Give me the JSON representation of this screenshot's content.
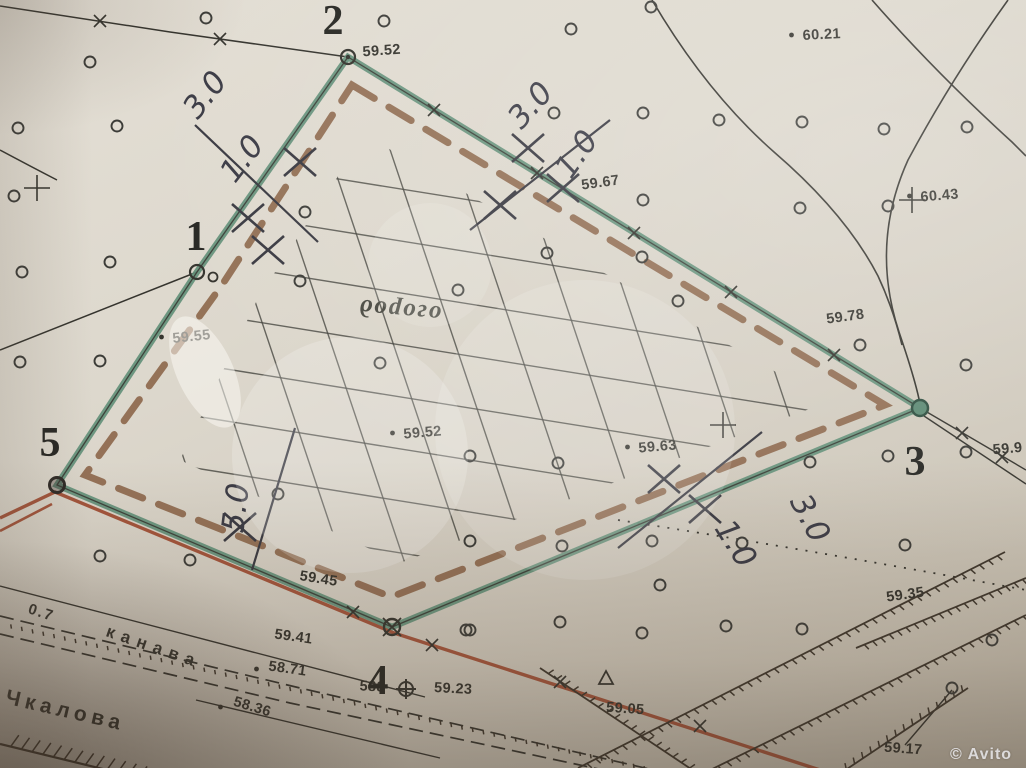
{
  "map": {
    "garden_label": {
      "text": "огород",
      "x": 400,
      "y": 303,
      "rot": 185
    },
    "corner_numbers": [
      {
        "text": "2",
        "x": 333,
        "y": 34
      },
      {
        "text": "1",
        "x": 196,
        "y": 250
      },
      {
        "text": "5",
        "x": 50,
        "y": 456
      },
      {
        "text": "4",
        "x": 378,
        "y": 694
      },
      {
        "text": "3",
        "x": 915,
        "y": 475
      }
    ],
    "elevation_points": [
      {
        "text": "59.52",
        "x": 382,
        "y": 55,
        "rot": -4,
        "dot": false
      },
      {
        "text": "60.21",
        "x": 822,
        "y": 39,
        "rot": -3,
        "dot": true
      },
      {
        "text": "60.43",
        "x": 940,
        "y": 200,
        "rot": -5,
        "dot": true
      },
      {
        "text": "59.67",
        "x": 601,
        "y": 187,
        "rot": -8,
        "dot": false
      },
      {
        "text": "59.55",
        "x": 192,
        "y": 341,
        "rot": -6,
        "dot": true
      },
      {
        "text": "59.78",
        "x": 846,
        "y": 321,
        "rot": -8,
        "dot": false
      },
      {
        "text": "59.52",
        "x": 423,
        "y": 437,
        "rot": -5,
        "dot": true
      },
      {
        "text": "59.63",
        "x": 658,
        "y": 451,
        "rot": -5,
        "dot": true
      },
      {
        "text": "59.9",
        "x": 1008,
        "y": 453,
        "rot": -5,
        "dot": false
      },
      {
        "text": "59.45",
        "x": 318,
        "y": 583,
        "rot": 9,
        "dot": false
      },
      {
        "text": "59.41",
        "x": 293,
        "y": 641,
        "rot": 8,
        "dot": false
      },
      {
        "text": "58.71",
        "x": 287,
        "y": 673,
        "rot": 8,
        "dot": true
      },
      {
        "text": "588",
        "x": 372,
        "y": 691,
        "rot": 3,
        "dot": false
      },
      {
        "text": "59.23",
        "x": 453,
        "y": 693,
        "rot": 3,
        "dot": false
      },
      {
        "text": "58.36",
        "x": 251,
        "y": 711,
        "rot": 17,
        "dot": true
      },
      {
        "text": "59.05",
        "x": 625,
        "y": 713,
        "rot": 4,
        "dot": false
      },
      {
        "text": "59.35",
        "x": 906,
        "y": 599,
        "rot": -8,
        "dot": false
      },
      {
        "text": "59.17",
        "x": 903,
        "y": 753,
        "rot": 4,
        "dot": false
      }
    ],
    "handwritten_measurements": [
      {
        "text": "3.0",
        "x": 213,
        "y": 101,
        "rot": -52
      },
      {
        "text": "1.0",
        "x": 250,
        "y": 165,
        "rot": -52
      },
      {
        "text": "3.0",
        "x": 538,
        "y": 112,
        "rot": -48
      },
      {
        "text": "1.0",
        "x": 585,
        "y": 160,
        "rot": -55
      },
      {
        "text": "5.0",
        "x": 246,
        "y": 509,
        "rot": -83
      },
      {
        "text": "1.0",
        "x": 727,
        "y": 549,
        "rot": 58
      },
      {
        "text": "3.0",
        "x": 801,
        "y": 523,
        "rot": 62
      }
    ],
    "street_labels": [
      {
        "text": "0.7",
        "x": 40,
        "y": 617,
        "rot": 18,
        "ls": 2,
        "size": 15
      },
      {
        "text": "канава",
        "x": 152,
        "y": 652,
        "rot": 19,
        "ls": 7,
        "size": 17
      },
      {
        "text": "Чкалова",
        "x": 64,
        "y": 717,
        "rot": 13,
        "ls": 5,
        "size": 21
      }
    ],
    "watermark": {
      "symbol": "©",
      "text": "Avito"
    },
    "colors": {
      "c-paper": "#d9d4c9",
      "c-green": "#63907a",
      "c-brown": "#8a6347",
      "c-red": "#a3543b",
      "c-ink": "#35342e",
      "c-pen": "#3b3b45"
    }
  }
}
